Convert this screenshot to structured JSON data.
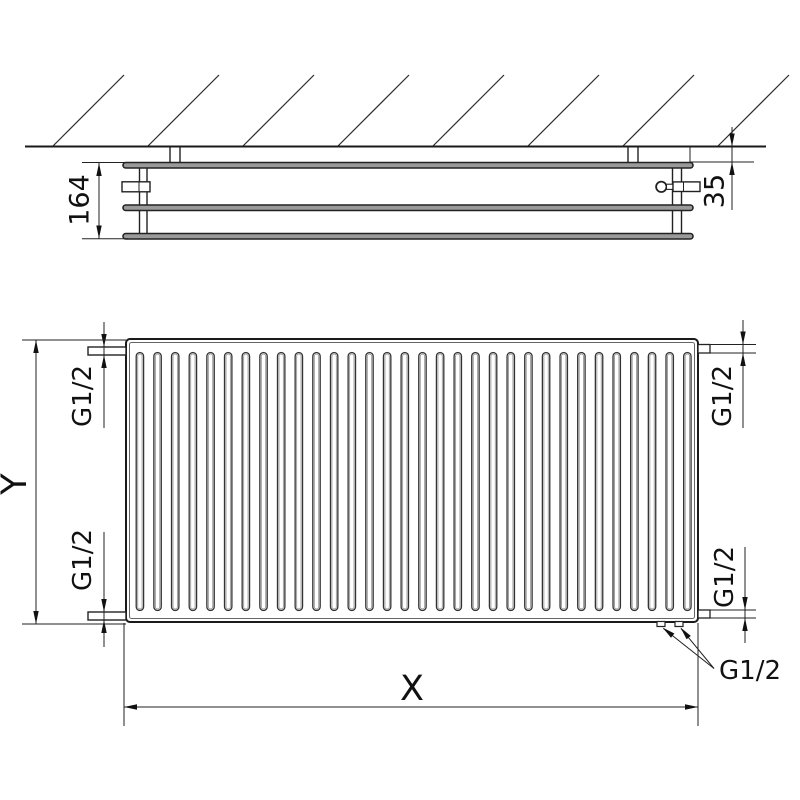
{
  "top_view": {
    "depth_label": "164",
    "wall_gap_label": "35"
  },
  "front_view": {
    "height_label": "Y",
    "width_label": "X",
    "fin_count": 32,
    "connections": {
      "top_left": "G1/2",
      "bottom_left": "G1/2",
      "top_right": "G1/2",
      "bottom_right": "G1/2",
      "bottom_center": "G1/2"
    }
  },
  "colors": {
    "line": "#222222",
    "text": "#111111",
    "background": "#ffffff"
  }
}
